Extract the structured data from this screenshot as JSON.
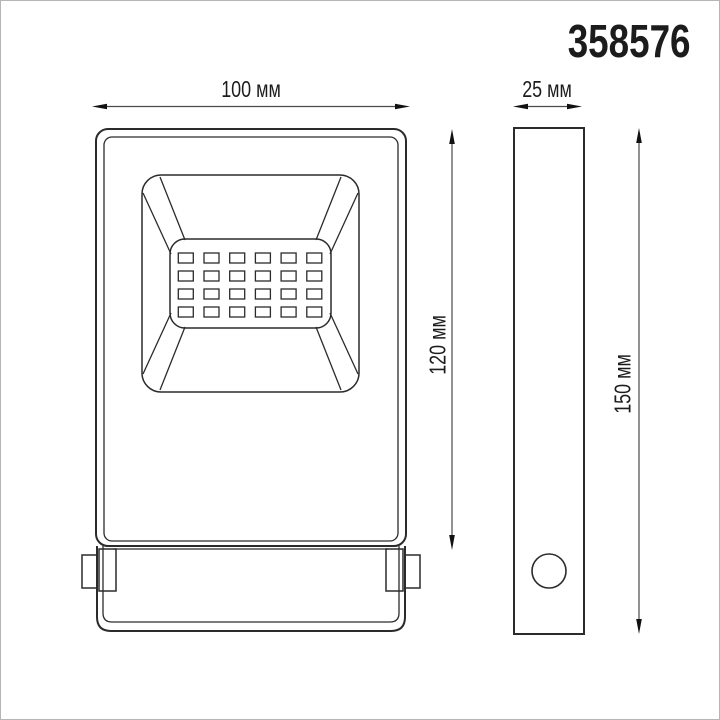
{
  "product": {
    "article": "358576"
  },
  "front_view": {
    "title": "front-view-of-led-floodlight",
    "width_dimension": {
      "label": "100 мм",
      "value": 100,
      "unit": "мм"
    },
    "height_dimension": {
      "label": "120 мм",
      "value": 120,
      "unit": "мм"
    },
    "led_grid": {
      "rows": 4,
      "columns": 6,
      "count": 24
    }
  },
  "side_view": {
    "title": "side-view-of-led-floodlight",
    "depth_dimension": {
      "label": "25 мм",
      "value": 25,
      "unit": "мм"
    },
    "height_dimension": {
      "label": "150 мм",
      "value": 150,
      "unit": "мм"
    }
  },
  "colors": {
    "line": "#2b2b2b",
    "dimension_line": "#4a4a4a",
    "arrowhead": "#111111",
    "text": "#1c1c1c",
    "frame": "#b5b5b5",
    "background": "#ffffff"
  }
}
